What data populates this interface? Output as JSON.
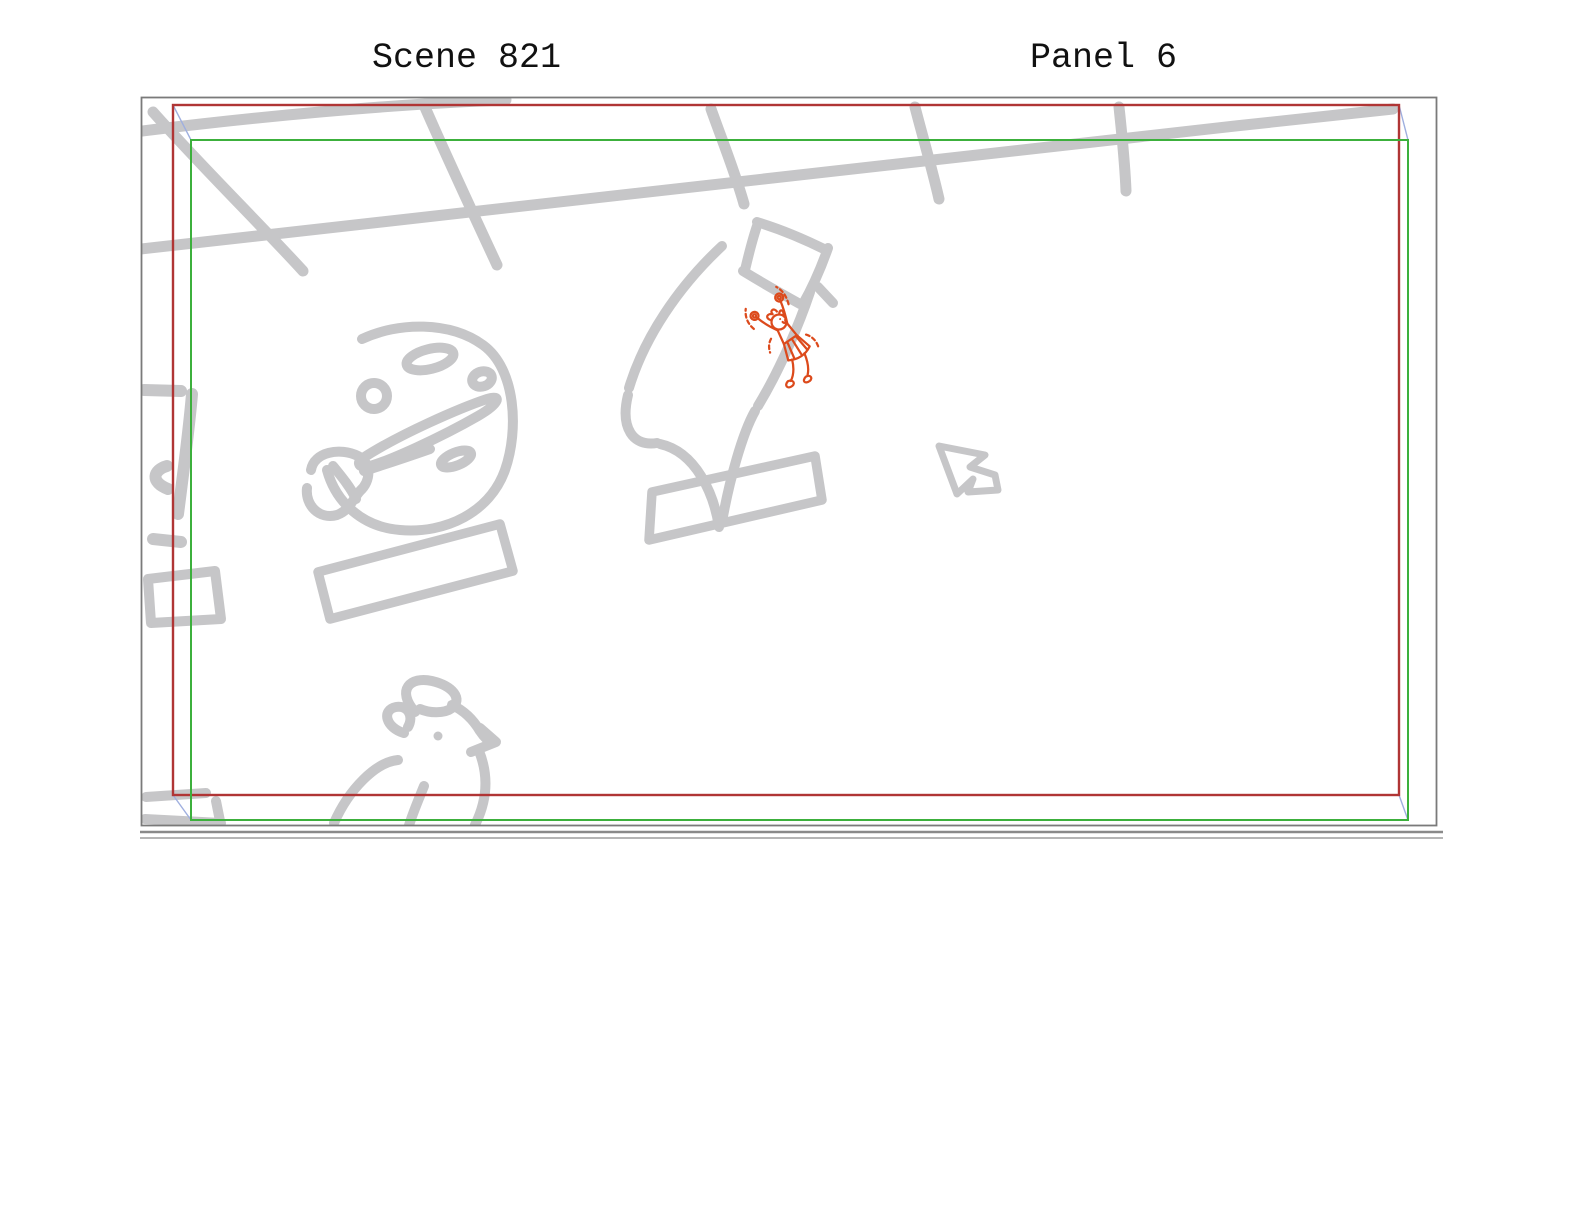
{
  "header": {
    "scene_label": "Scene 821",
    "panel_label": "Panel 6"
  },
  "colors": {
    "ink": "#c6c6c8",
    "accent": "#dc4a1c",
    "camera-start": "#b03535",
    "camera-end": "#3cb03c",
    "connector": "#9fafdf",
    "frame-border": "#7a7a7a",
    "rule": "#8a8a8a",
    "text": "#111111"
  },
  "canvas": {
    "camera_frames": {
      "start": "camera start frame (red)",
      "end": "camera end frame (green)",
      "connectors": "corner motion connectors (blue)"
    },
    "sketch_elements": [
      "perspective-grid",
      "left-edge-marks",
      "palette-doodle",
      "palette-label-bar",
      "capsule-with-cap-doodle",
      "center-label-bar",
      "cheering-character (accent red ink)",
      "cursor-arrow-doodle",
      "chicken-doodle",
      "bottom-left-marks"
    ]
  }
}
